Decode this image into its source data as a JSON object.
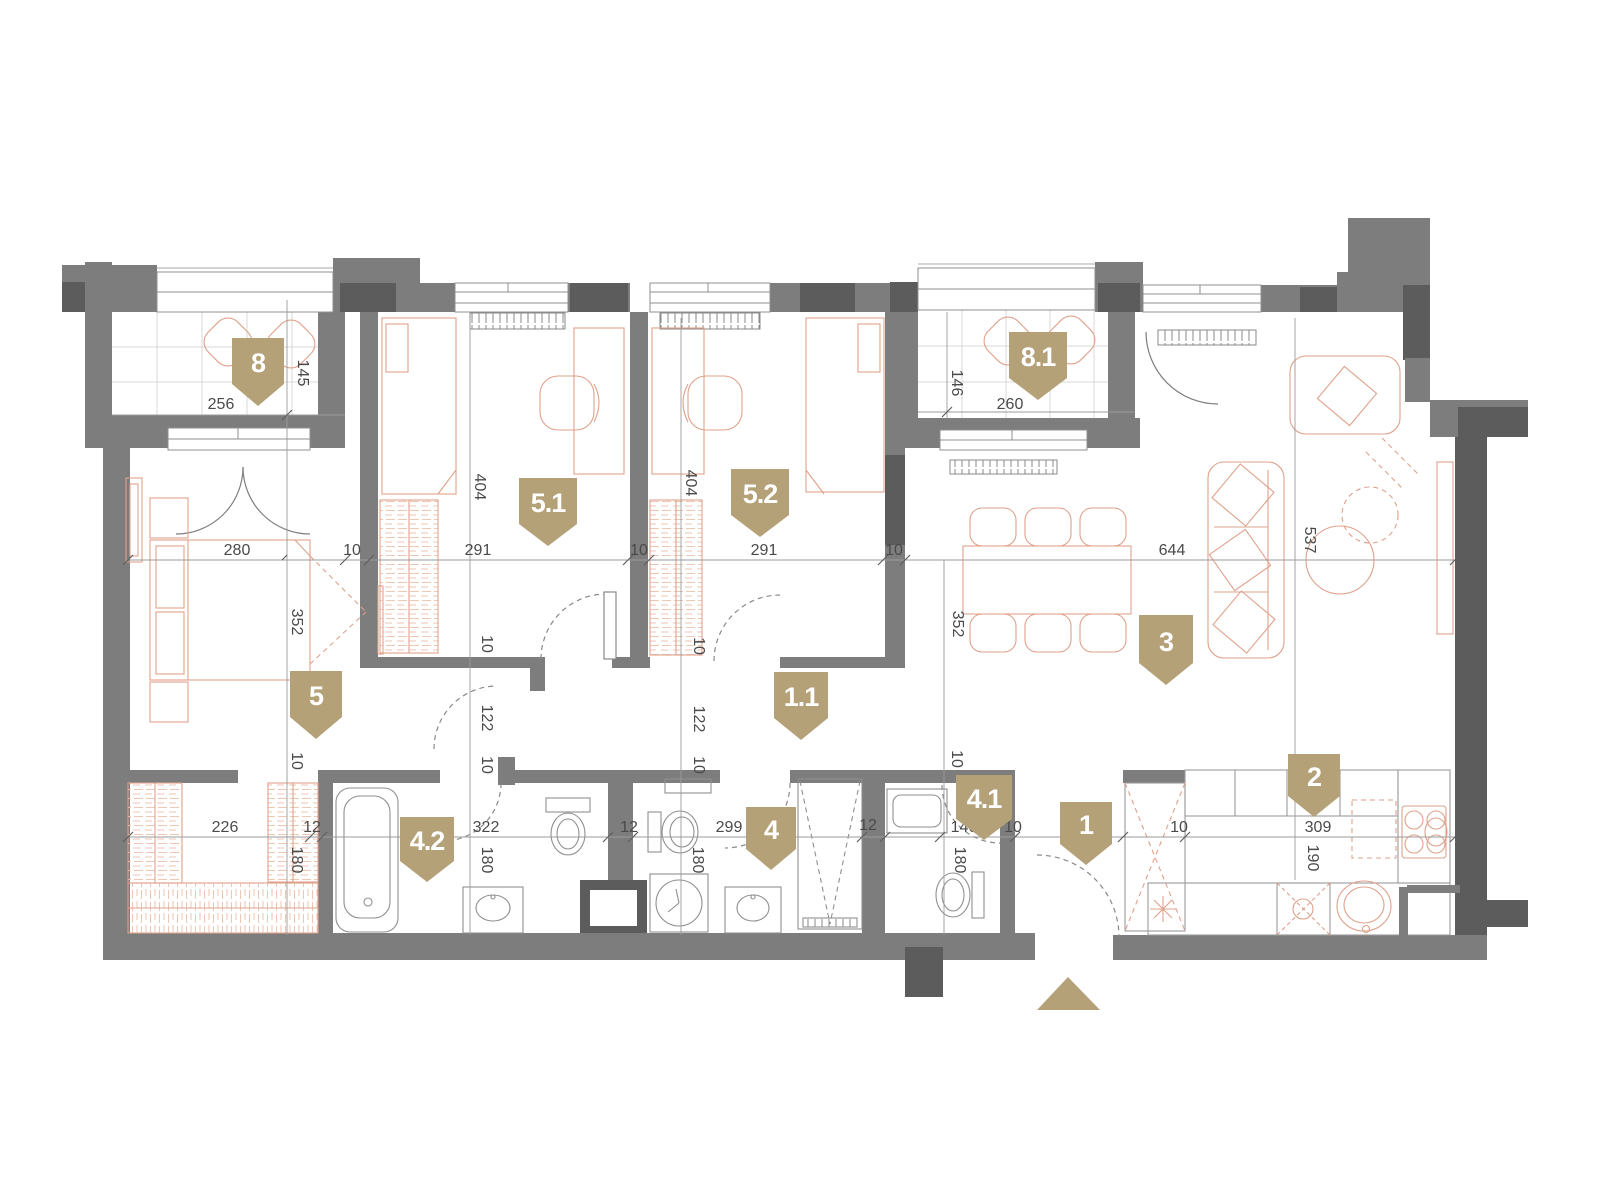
{
  "plan_type": "apartment-floor-plan",
  "colors": {
    "wall": "#7d7d7d",
    "wall_dark": "#5c5c5c",
    "furniture_outline": "#dfa18a",
    "furniture_hatch": "#edc6b4",
    "badge": "#b5a178",
    "dimension_text": "#4a4a4a",
    "dimension_line": "#9b9b9b",
    "tile_grid": "#d9d9d9",
    "background": "#ffffff"
  },
  "badges": [
    {
      "id": "8",
      "label": "8"
    },
    {
      "id": "8.1",
      "label": "8.1"
    },
    {
      "id": "5.1",
      "label": "5.1"
    },
    {
      "id": "5.2",
      "label": "5.2"
    },
    {
      "id": "5",
      "label": "5"
    },
    {
      "id": "1.1",
      "label": "1.1"
    },
    {
      "id": "3",
      "label": "3"
    },
    {
      "id": "4.2",
      "label": "4.2"
    },
    {
      "id": "4",
      "label": "4"
    },
    {
      "id": "4.1",
      "label": "4.1"
    },
    {
      "id": "1",
      "label": "1"
    },
    {
      "id": "2",
      "label": "2"
    }
  ],
  "dims": [
    "256",
    "145",
    "260",
    "146",
    "280",
    "10",
    "291",
    "10",
    "291",
    "10",
    "644",
    "404",
    "404",
    "352",
    "352",
    "537",
    "10",
    "122",
    "10",
    "10",
    "122",
    "10",
    "10",
    "226",
    "12",
    "180",
    "322",
    "180",
    "12",
    "299",
    "180",
    "12",
    "140",
    "10",
    "180",
    "10",
    "10",
    "309",
    "190"
  ],
  "entrance": {
    "icon": "up-arrow",
    "meaning": "entrance direction"
  }
}
